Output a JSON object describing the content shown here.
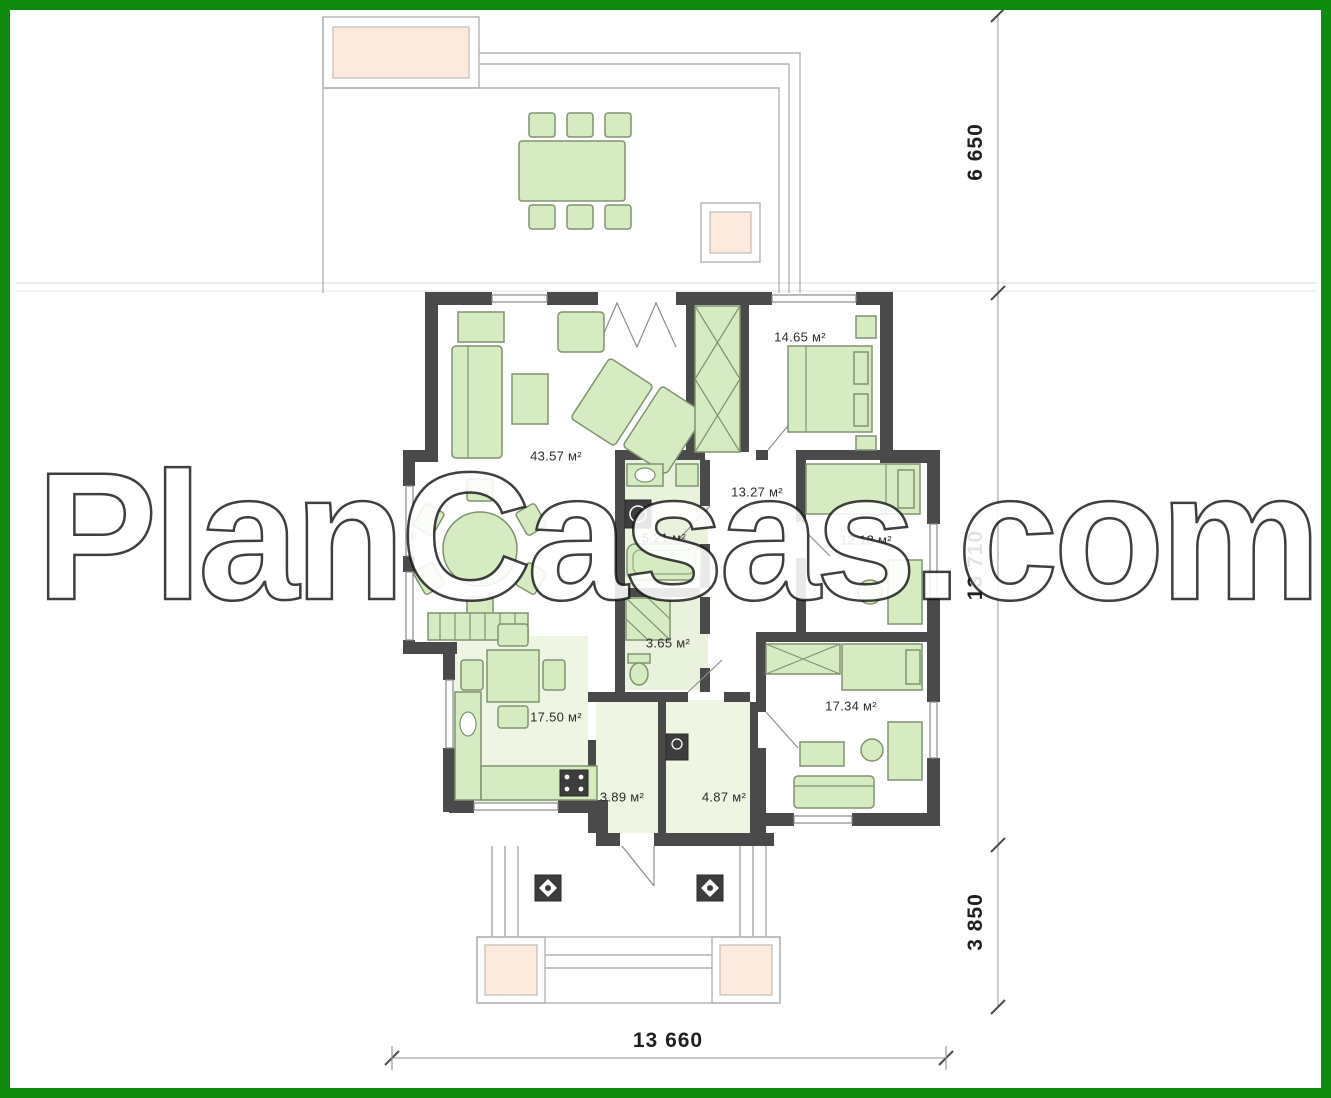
{
  "watermark": "PlanCasas.com",
  "colors": {
    "frame": "#0e8a0e",
    "wall": "#4a4a4a",
    "furniture": "#d6ebc1",
    "furniture-stroke": "#7f9370",
    "floor-tint": "#e9f2dc",
    "planter": "#fceadf"
  },
  "rooms": [
    {
      "name": "living-room",
      "area_label": "43.57 м²"
    },
    {
      "name": "bedroom-1",
      "area_label": "14.65 м²"
    },
    {
      "name": "hallway",
      "area_label": "13.27 м²"
    },
    {
      "name": "bathroom",
      "area_label": "5.21 м²"
    },
    {
      "name": "wc",
      "area_label": "3.65 м²"
    },
    {
      "name": "bedroom-2",
      "area_label": "12.18 м²"
    },
    {
      "name": "bedroom-3",
      "area_label": "17.34 м²"
    },
    {
      "name": "kitchen",
      "area_label": "17.50 м²"
    },
    {
      "name": "pantry",
      "area_label": "3.89 м²"
    },
    {
      "name": "entry-hall",
      "area_label": "4.87 м²"
    }
  ],
  "dimensions": {
    "right_top": "6 650",
    "right_middle": "13 710",
    "right_bottom": "3 850",
    "bottom": "13 660"
  }
}
